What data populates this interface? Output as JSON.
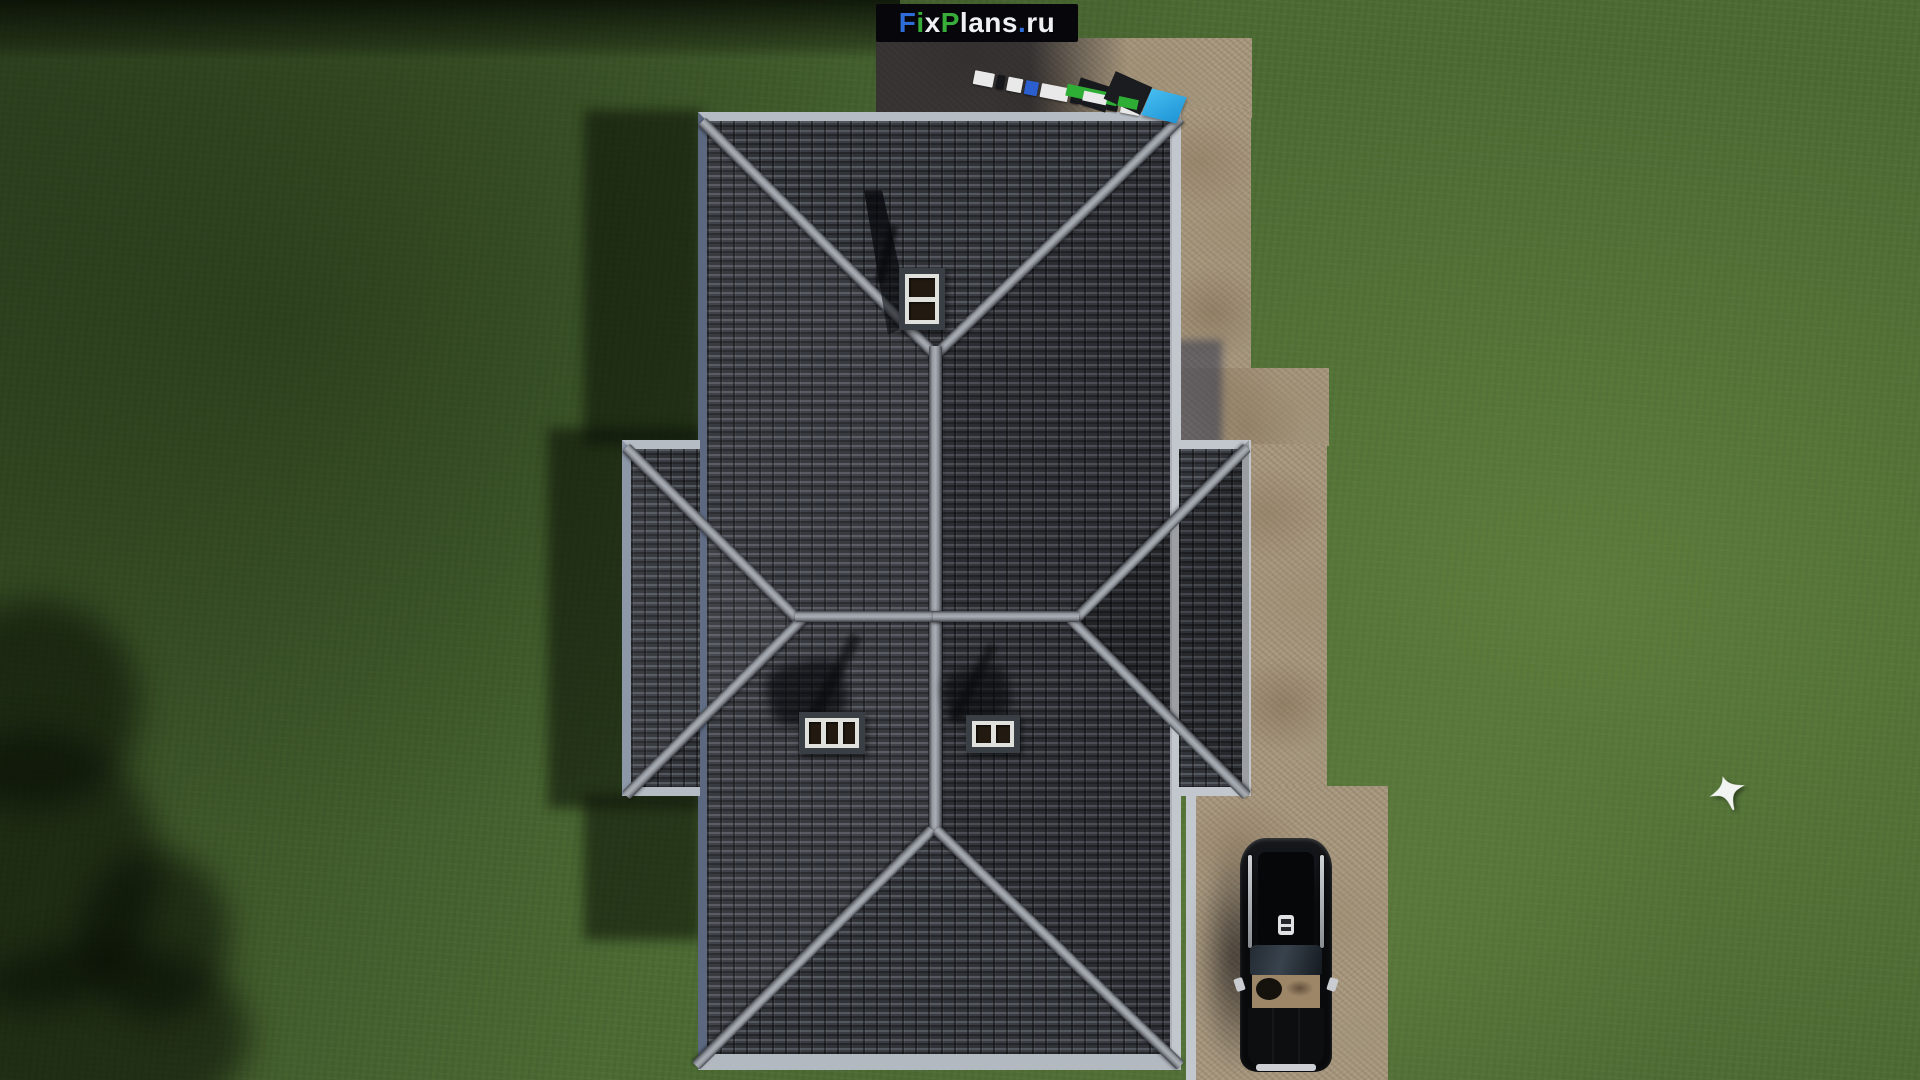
{
  "watermark": {
    "label": "FixPlans.ru",
    "background": "#07070b",
    "parts": [
      {
        "text": "F",
        "color": "#2e6cd8"
      },
      {
        "text": "i",
        "color": "#38ad3a"
      },
      {
        "text": "x",
        "color": "#eff0f2"
      },
      {
        "text": "P",
        "color": "#38ad3a"
      },
      {
        "text": "lans",
        "color": "#eff0f2"
      },
      {
        "text": ".",
        "color": "#2e6cd8"
      },
      {
        "text": "ru",
        "color": "#eff0f2"
      }
    ]
  },
  "scene": {
    "description": "Aerial top-down 3D render of a house plan: gray tiled cross-hip roof with three chimneys, light eave trim, stone-paved yard and driveway on the right with a parked black SUV, green lawn with building and tree shadows, a white bird flying over the grass, and survey scale markers with a blue flag near the top pavement",
    "grass_color": "#4c6b33",
    "grass_shadow_color": "#17230e",
    "roof_tile_color": "#2e3136",
    "roof_ridge_color": "#9599a0",
    "roof_eave_color": "#b6bcc4",
    "pavement_color": "#a6967d",
    "pavement_shadow_color": "#282a36",
    "driveway_curb_color": "#c3c8ce",
    "car_color": "#0a0b0d",
    "car_interior_color": "#9d8668",
    "car_bumper_color": "#ccd0d4",
    "chimney_color": "#e0e0dc",
    "chimney_count": 3,
    "bird_color": "#f2f4f2",
    "survey_flag_color": "#2aa8e2",
    "survey_marker_green": "#2fae35"
  },
  "scale_bar": {
    "segments": [
      {
        "color": "#e9e9e9",
        "w": 22
      },
      {
        "color": "#15171b",
        "w": 8
      },
      {
        "color": "#e9e9e9",
        "w": 16
      },
      {
        "color": "#2b5fd0",
        "w": 14
      },
      {
        "color": "#e9e9e9",
        "w": 30
      },
      {
        "color": "#15171b",
        "w": 10
      },
      {
        "color": "#e9e9e9",
        "w": 24
      },
      {
        "color": "#15171b",
        "w": 12
      },
      {
        "color": "#e9e9e9",
        "w": 20
      }
    ]
  }
}
